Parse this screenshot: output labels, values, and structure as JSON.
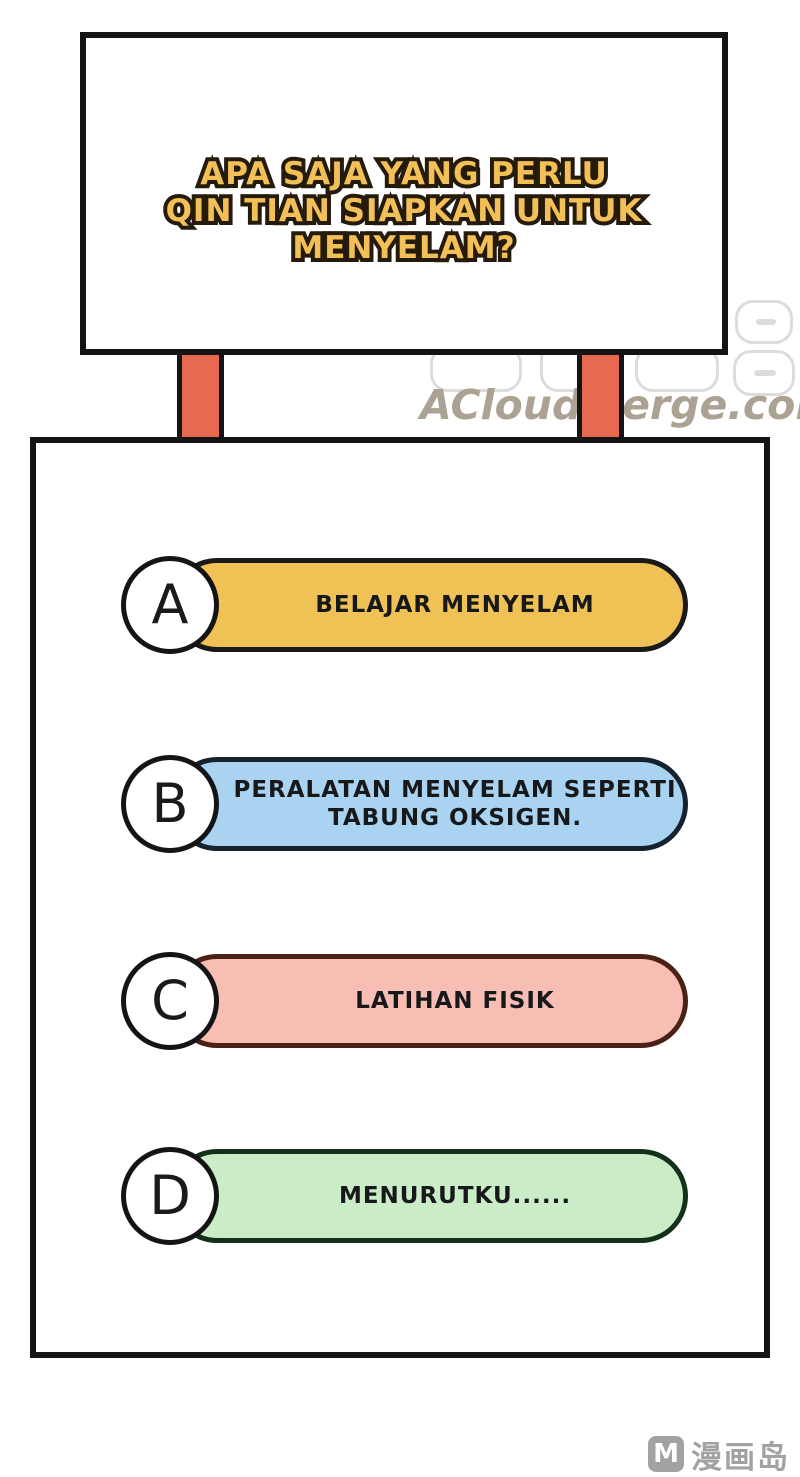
{
  "sign": {
    "title_lines": [
      "APA SAJA YANG PERLU",
      "QIN TIAN SIAPKAN UNTUK",
      "MENYELAM?"
    ],
    "text_color": "#F2C057",
    "outline_color": "#251B0D"
  },
  "watermark": {
    "site_text": "ACloudMerge.com",
    "color": "#ABA294"
  },
  "quiz": {
    "options": [
      {
        "letter": "A",
        "lines": [
          "BELAJAR MENYELAM"
        ],
        "fill": "#F0C155",
        "border": "#191919"
      },
      {
        "letter": "B",
        "lines": [
          "PERALATAN MENYELAM SEPERTI",
          "TABUNG OKSIGEN."
        ],
        "fill": "#A9D3F1",
        "border": "#16222E"
      },
      {
        "letter": "C",
        "lines": [
          "LATIHAN FISIK"
        ],
        "fill": "#F8BDB3",
        "border": "#4A2017"
      },
      {
        "letter": "D",
        "lines": [
          "MENURUTKU......"
        ],
        "fill": "#CAECC6",
        "border": "#12301B"
      }
    ]
  },
  "logo": {
    "m": "M",
    "text": "漫画岛",
    "color": "#A2A2A2"
  },
  "colors": {
    "post_fill": "#E76A50",
    "panel_outline": "#141414"
  }
}
